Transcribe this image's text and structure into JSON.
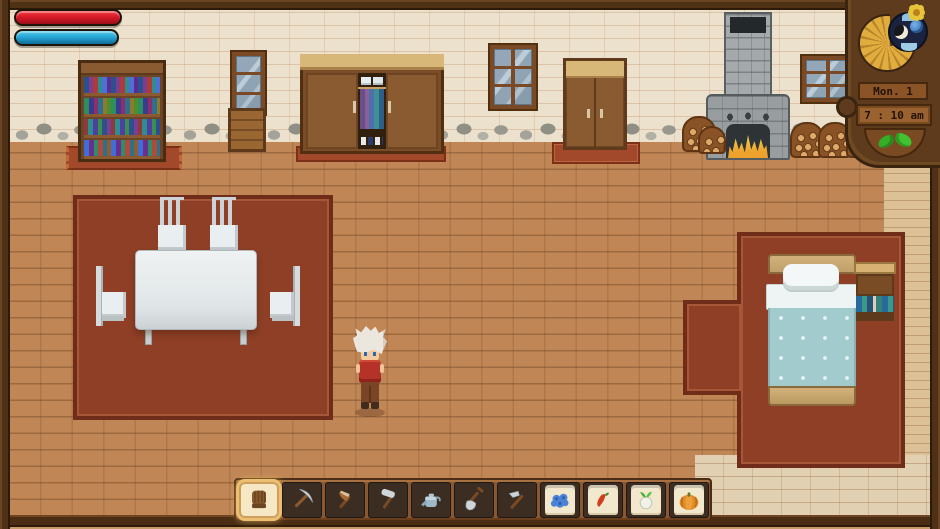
{
  "hud": {
    "health": {
      "value_pct": 100,
      "color": "#d81a28"
    },
    "mana": {
      "value_pct": 100,
      "color": "#28a8d8"
    },
    "calendar": {
      "date_label": "Mon. 1",
      "time_label": "7 : 10 am",
      "season_icon": "seedling",
      "dial_icons": [
        "moon",
        "planet",
        "day-sky"
      ]
    }
  },
  "hotbar": {
    "selected_index": 0,
    "slots": [
      {
        "name": "glove",
        "icon": "glove",
        "packet": false
      },
      {
        "name": "pickaxe",
        "icon": "pickaxe",
        "packet": false
      },
      {
        "name": "axe",
        "icon": "axe",
        "packet": false
      },
      {
        "name": "hammer",
        "icon": "hammer",
        "packet": false
      },
      {
        "name": "watering-can",
        "icon": "watering-can",
        "packet": false
      },
      {
        "name": "shovel",
        "icon": "shovel",
        "packet": false
      },
      {
        "name": "hoe",
        "icon": "hoe",
        "packet": false
      },
      {
        "name": "blue-seeds",
        "icon": "seeds-blue",
        "packet": true
      },
      {
        "name": "pepper-seeds",
        "icon": "pepper",
        "packet": true
      },
      {
        "name": "turnip-seeds",
        "icon": "turnip",
        "packet": true
      },
      {
        "name": "pumpkin-seeds",
        "icon": "pumpkin",
        "packet": true
      }
    ]
  },
  "scene": {
    "location": "house-interior",
    "furniture": [
      "bookshelf",
      "narrow-window",
      "crate",
      "wardrobe",
      "double-window",
      "door",
      "double-window",
      "fireplace",
      "firewood-piles",
      "dining-rug",
      "dining-table",
      "chairs",
      "bed",
      "bed-rug",
      "nightstand-bookshelf"
    ],
    "character": {
      "hair": "white",
      "shirt": "red",
      "pants": "brown",
      "facing": "down"
    }
  },
  "colors": {
    "wall": "#ebe1cc",
    "floor": "#c08656",
    "rug": "#8e3f26",
    "frame_wood": "#4f3116",
    "hud_wood": "#5d3b1c",
    "health_red": "#d81a28",
    "mana_blue": "#28a8d8",
    "selected_slot_glow": "#ecc070",
    "fire": "#f6df52",
    "blanket": "#a2cbcd"
  }
}
